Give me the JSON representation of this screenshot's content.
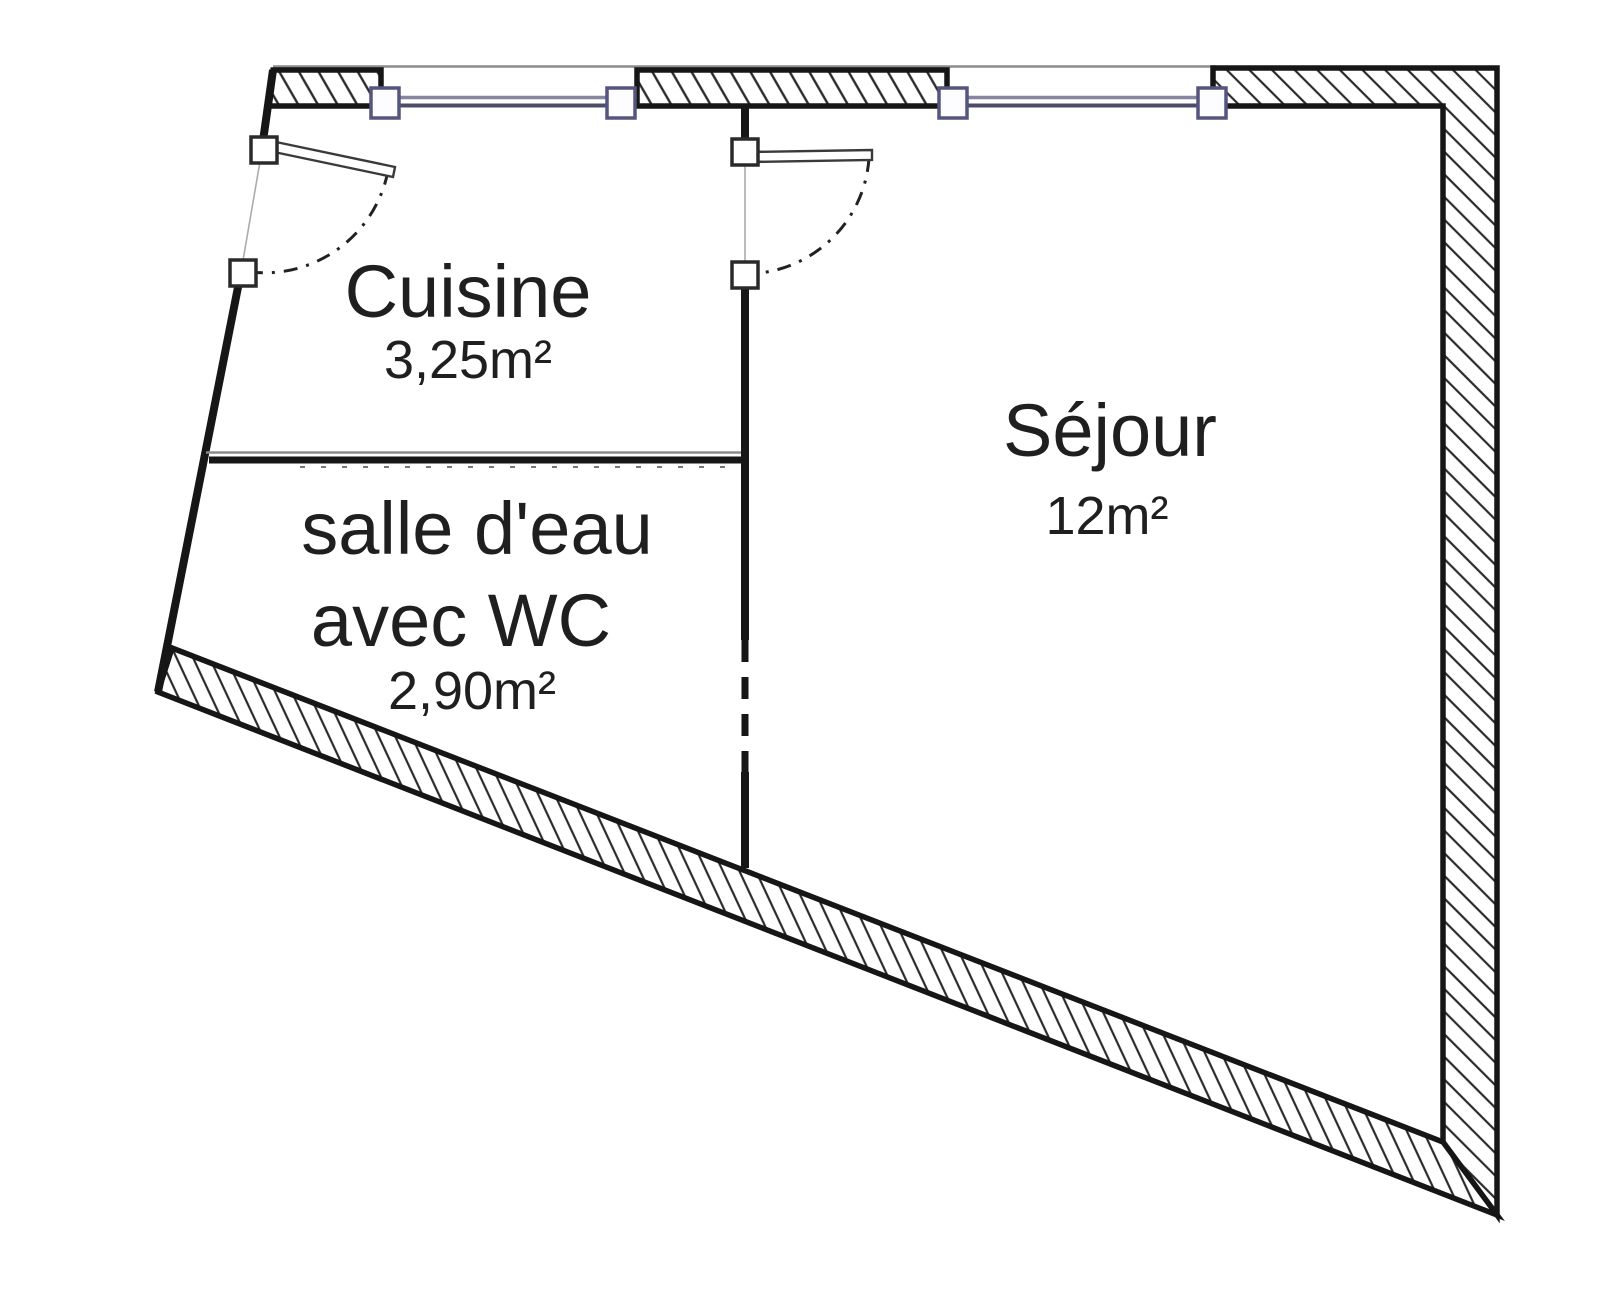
{
  "plan": {
    "rooms": {
      "cuisine": {
        "label": "Cuisine",
        "area": "3,25m²"
      },
      "salle_eau": {
        "label_line1": "salle d'eau",
        "label_line2": "avec WC",
        "area": "2,90m²"
      },
      "sejour": {
        "label": "Séjour",
        "area": "12m²"
      }
    },
    "colors": {
      "wall": "#161616",
      "text": "#1f1f1f",
      "window_frame": "#55557d",
      "window_line_light": "#8686a0",
      "window_line_dark": "#4c4c6a",
      "opening_line": "#ababab",
      "top_guide_line": "#8c8c8c"
    }
  }
}
